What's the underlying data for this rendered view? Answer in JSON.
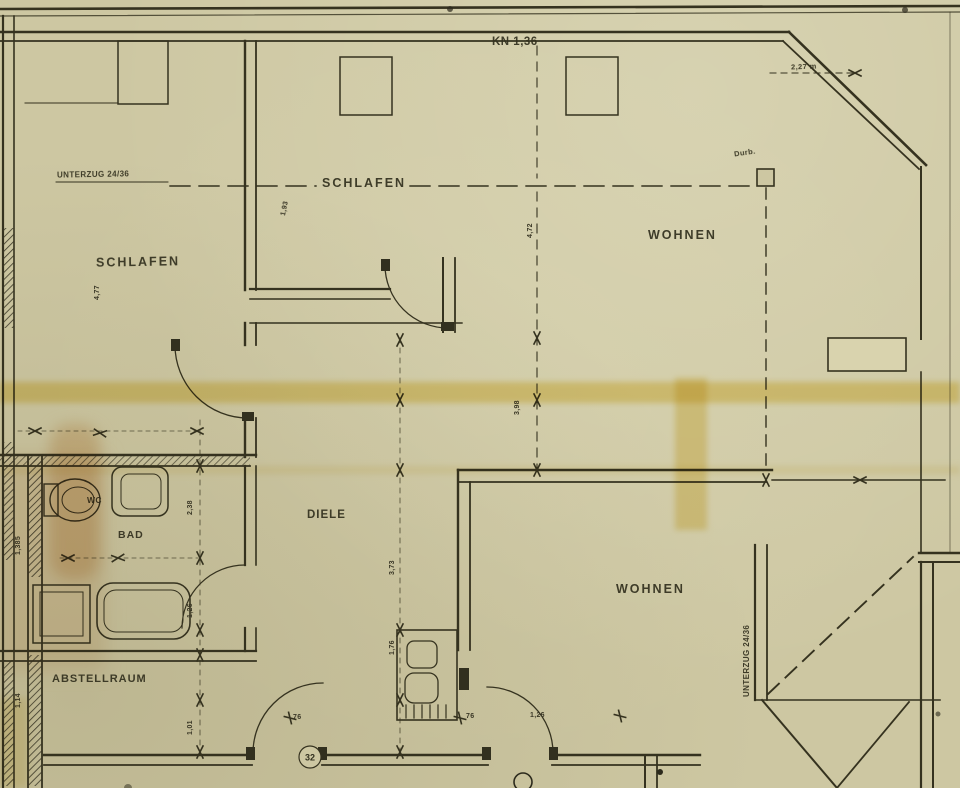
{
  "document": {
    "kind": "scanned architectural floor plan (German)"
  },
  "colors": {
    "paper": "#cdc7a2",
    "ink": "#32301f",
    "highlight_yellow": "#e3bd1e",
    "highlight_orange": "#d99f58"
  },
  "rooms": {
    "schlafen_left": "SCHLAFEN",
    "schlafen_mid": "SCHLAFEN",
    "wohnen_top": "WOHNEN",
    "wohnen_bottom": "WOHNEN",
    "diele": "DIELE",
    "bad": "BAD",
    "wc": "WC",
    "abstellraum": "ABSTELLRAUM"
  },
  "annotations": {
    "kn": "KN 1,36",
    "unterzug_top": "UNTERZUG 24/36",
    "unterzug_right": "UNTERZUG 24/36",
    "durchbruch": "Durb.",
    "dim_top_right": "2,27 m",
    "door_circle": "32"
  },
  "dimensions": [
    {
      "text": "4,77",
      "x": 94,
      "y": 300,
      "rot": -90
    },
    {
      "text": "1,93",
      "x": 280,
      "y": 215,
      "rot": -78
    },
    {
      "text": "4,72",
      "x": 527,
      "y": 238,
      "rot": -90
    },
    {
      "text": "3,98",
      "x": 514,
      "y": 415,
      "rot": -90
    },
    {
      "text": "3,73",
      "x": 389,
      "y": 575,
      "rot": -90
    },
    {
      "text": "1,76",
      "x": 389,
      "y": 655,
      "rot": -90
    },
    {
      "text": "2,38",
      "x": 187,
      "y": 515,
      "rot": -90
    },
    {
      "text": "1,26",
      "x": 187,
      "y": 618,
      "rot": -90
    },
    {
      "text": "1,01",
      "x": 187,
      "y": 735,
      "rot": -90
    },
    {
      "text": "1,385",
      "x": 15,
      "y": 555,
      "rot": -90
    },
    {
      "text": "1,14",
      "x": 15,
      "y": 708,
      "rot": -90
    },
    {
      "text": "76",
      "x": 293,
      "y": 714,
      "rot": 0
    },
    {
      "text": "76",
      "x": 466,
      "y": 713,
      "rot": 0
    },
    {
      "text": "1,26",
      "x": 530,
      "y": 712,
      "rot": 0
    }
  ]
}
